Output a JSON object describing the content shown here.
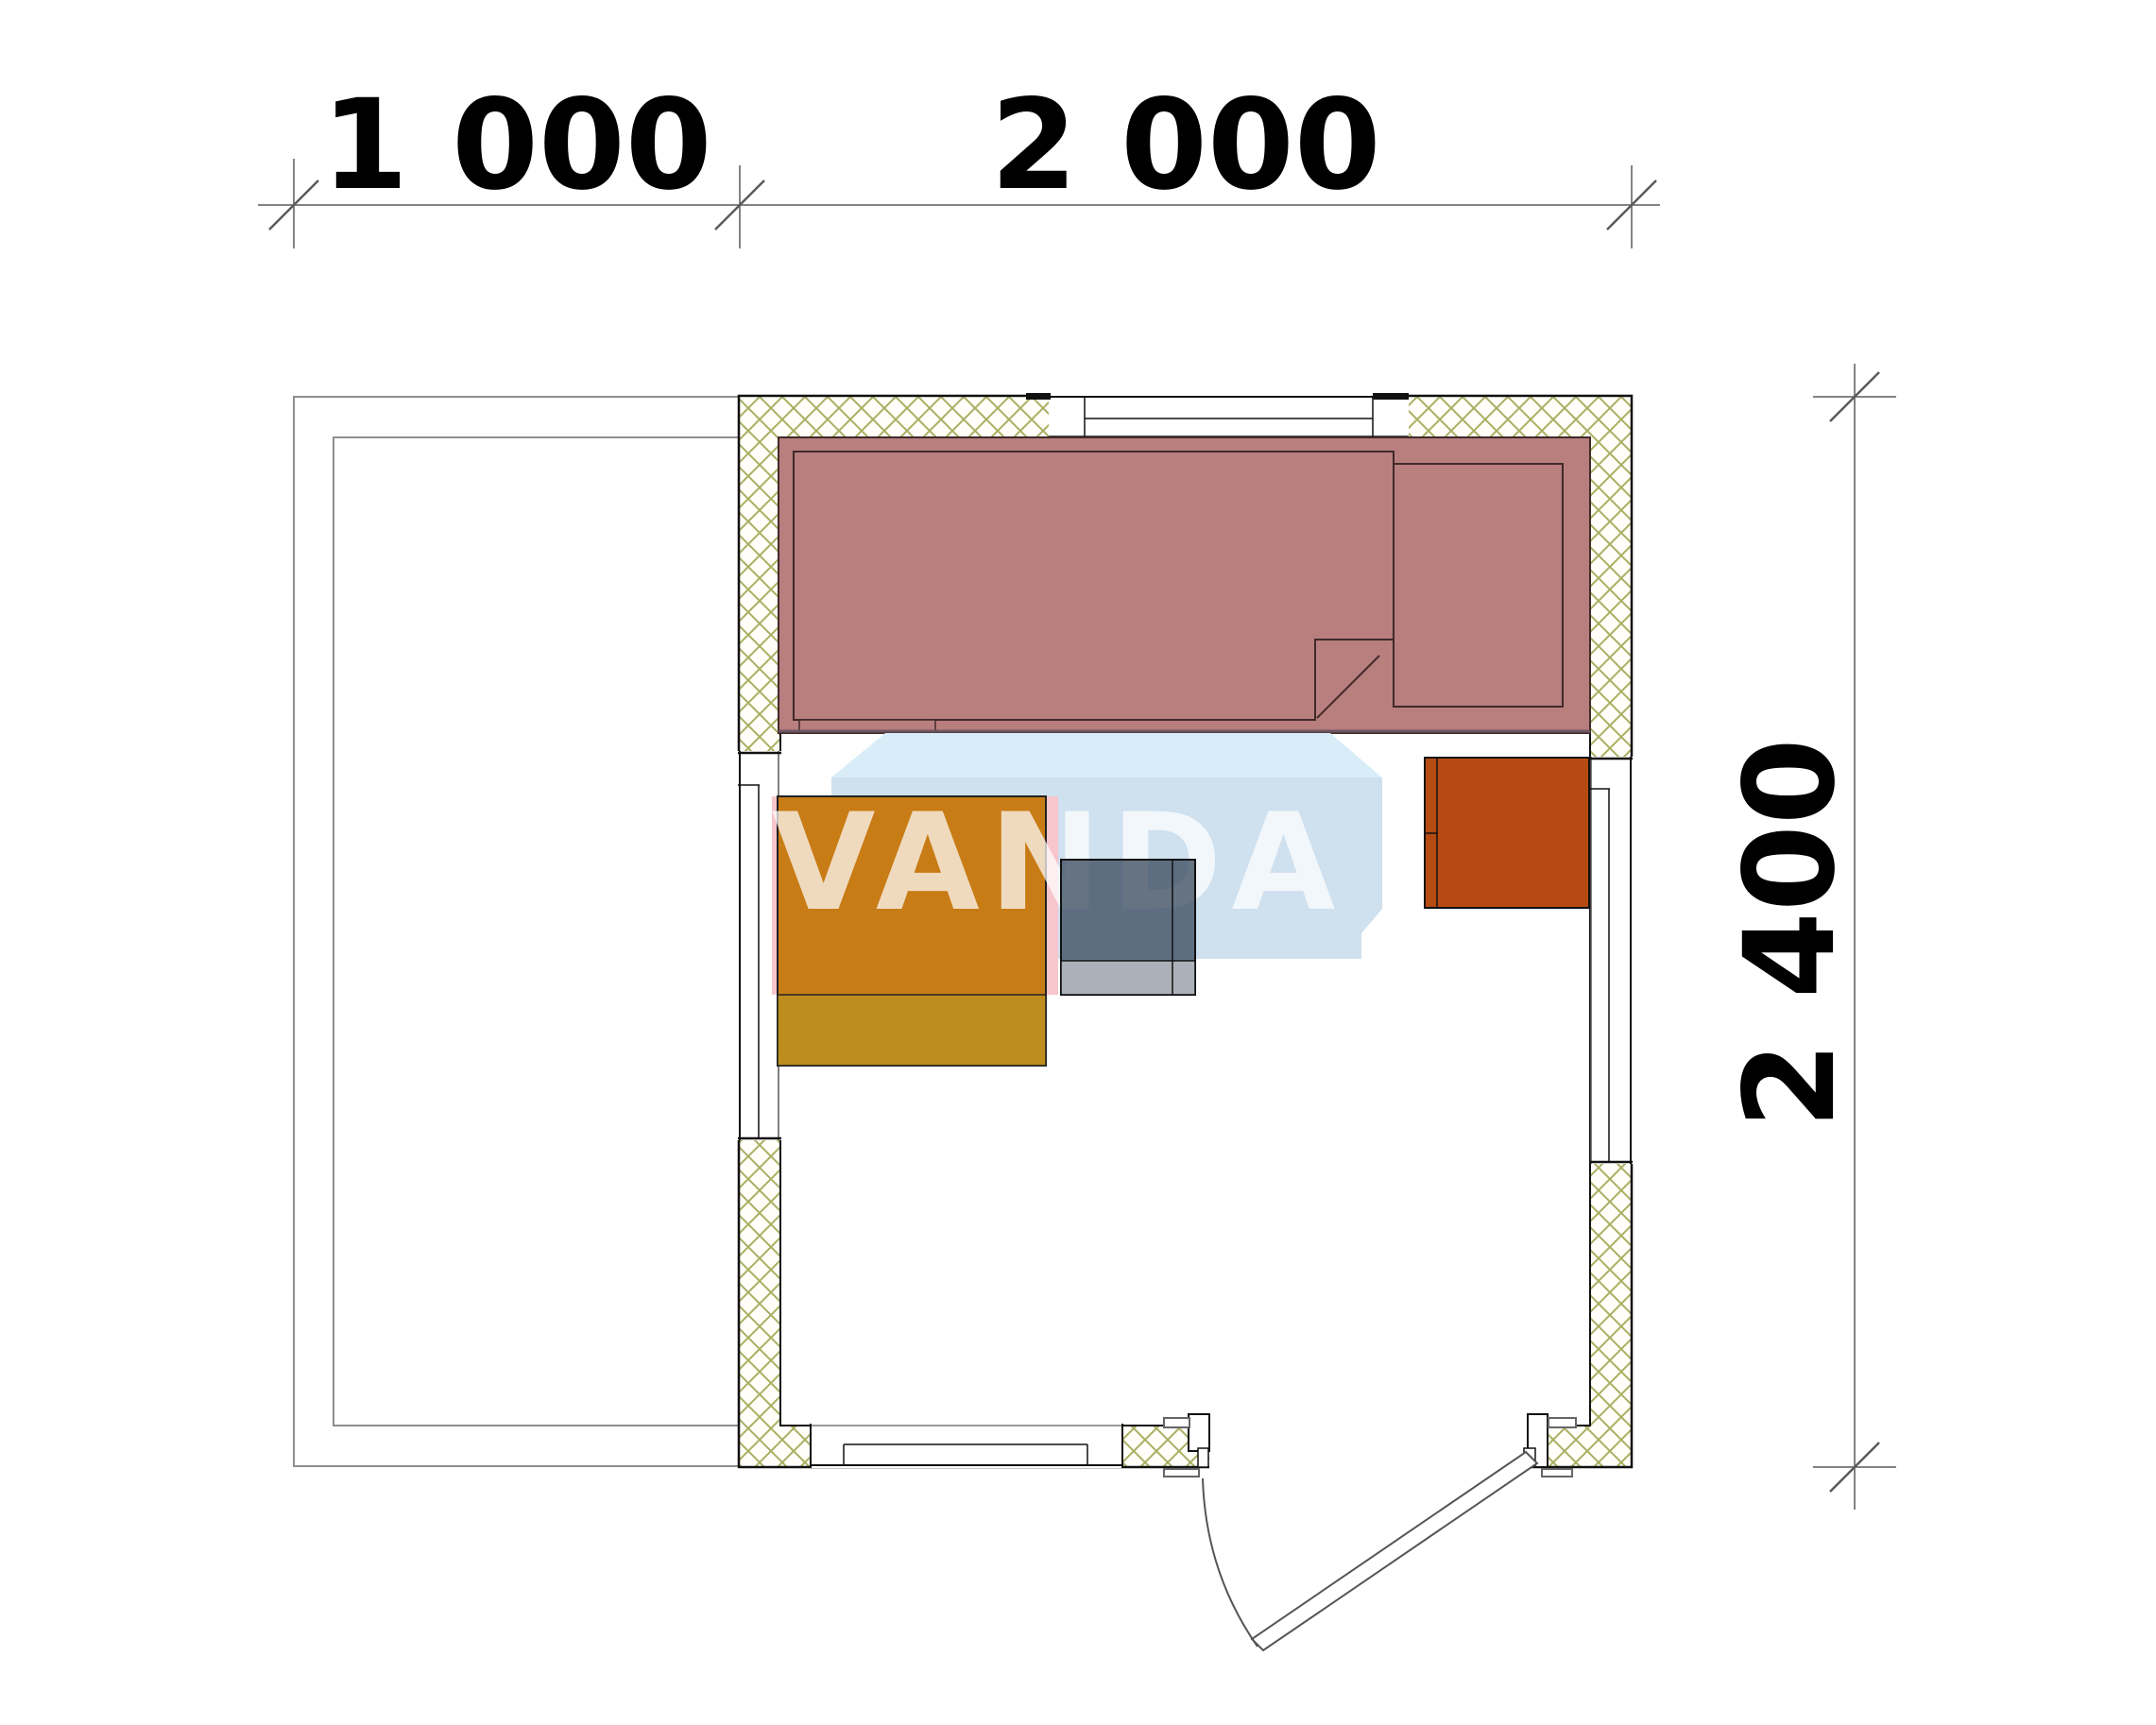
{
  "drawing": {
    "type": "floor-plan",
    "watermark_text": "VANDA"
  },
  "dimensions": {
    "top": [
      {
        "label": "1 000"
      },
      {
        "label": "2 000"
      }
    ],
    "right": {
      "label": "2 400"
    }
  },
  "colors": {
    "wall_hatch_line": "#aaaf62",
    "wall_outline": "#111111",
    "bench": "#b97e7e",
    "bench_outline": "#3f2a2a",
    "table_top": "#c87c16",
    "table_front": "#bd8e1e",
    "table_side_pink": "#f7c6cc",
    "heater": "#b54b12",
    "stool": "#3e4e61",
    "watermark_top_face": "#d9edf9",
    "watermark_front_face": "#cfe0ef",
    "dimension_line": "#5a5a5a",
    "terrace_line": "#8f8f8f"
  }
}
